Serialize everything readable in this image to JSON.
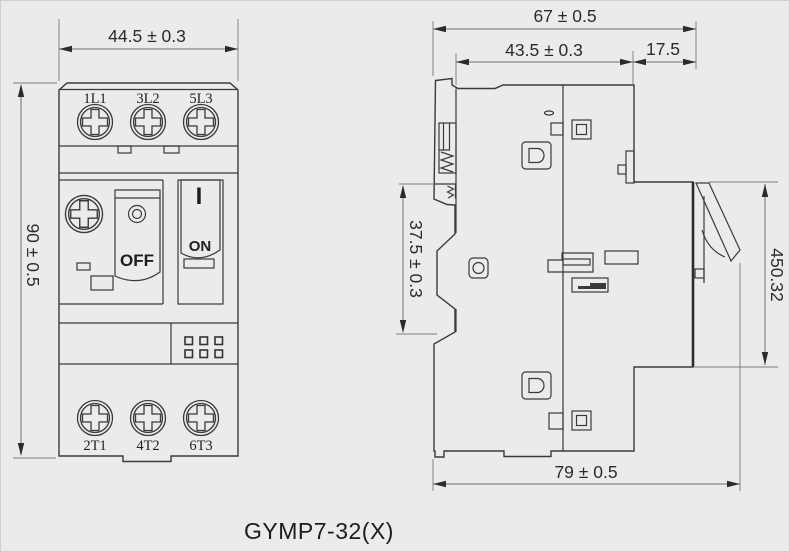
{
  "drawing": {
    "caption": "GYMP7-32(X)",
    "front_view": {
      "dim_width": "44.5 ± 0.3",
      "dim_height": "90 ± 0.5",
      "terminals_top": [
        "1L1",
        "3L2",
        "5L3"
      ],
      "terminals_bottom": [
        "2T1",
        "4T2",
        "6T3"
      ],
      "off_label": "OFF",
      "on_label": "ON",
      "on_mark": "I"
    },
    "side_view": {
      "dim_overall_width": "67 ± 0.5",
      "dim_body_width": "43.5 ± 0.3",
      "dim_handle_offset": "17.5",
      "dim_din_mount": "37.5 ± 0.3",
      "dim_right_side": "450.32",
      "dim_overall_depth": "79 ± 0.5"
    },
    "colors": {
      "background": "#ecebeb",
      "line": "#3a3a3a",
      "dimension": "#2b2b2b"
    }
  }
}
